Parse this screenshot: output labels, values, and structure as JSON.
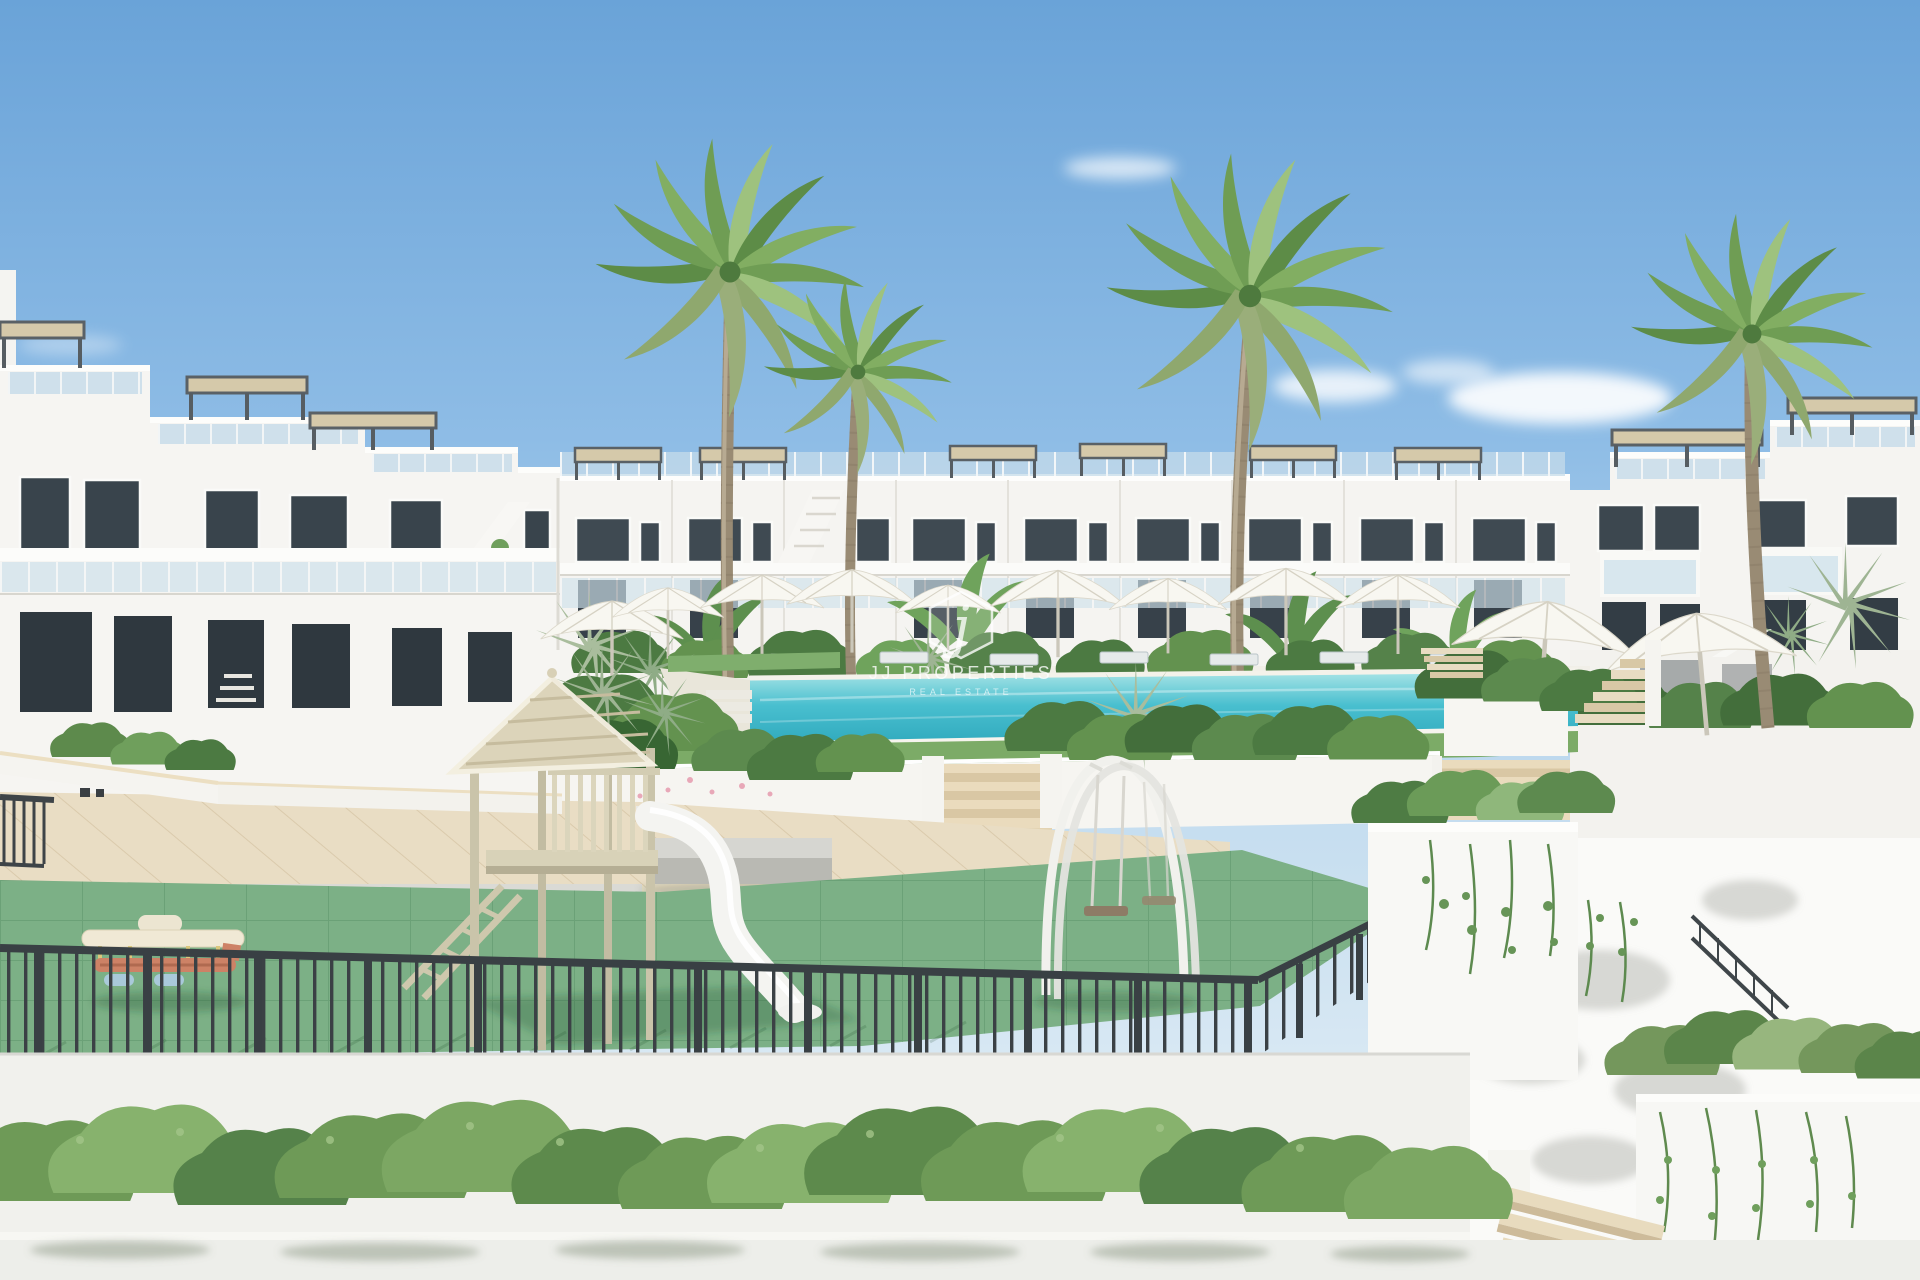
{
  "watermark": {
    "logo_letter": "j",
    "brand": "JJ PROPERTIES",
    "tagline": "REAL ESTATE"
  },
  "scene": {
    "setting": "sunny residential complex courtyard with pool and playground",
    "palette": {
      "sky_top": "#6aa3d8",
      "sky_horizon": "#e9f2f7",
      "building_white": "#f5f4f1",
      "building_shade": "#e6e4de",
      "window_glass": "#3f4a52",
      "balustrade_glass": "#c6dcea",
      "pergola_frame": "#575e63",
      "pergola_canopy": "#d5c9aa",
      "pool_light": "#a7e4e6",
      "pool_deep": "#2fa9bd",
      "lawn": "#7cab67",
      "paving": "#e9ddc4",
      "playground_floor": "#7cb086",
      "fence_metal": "#3b4145",
      "foliage_dark": "#4c7a42",
      "foliage_light": "#8fb77b",
      "concrete": "#bcbcb6",
      "timber": "#cac4aa",
      "slide_white": "#f4f4f1",
      "watermark_white": "#ffffff"
    },
    "elements": [
      "sky",
      "clouds",
      "apartment-building-left",
      "apartment-building-center",
      "apartment-building-right",
      "rooftop-pergolas",
      "rooftop-glass-railings",
      "palm-trees",
      "swimming-pool",
      "pool-umbrellas",
      "sun-loungers",
      "poolside-planters",
      "garden-stairs",
      "paved-plaza",
      "concrete-benches",
      "playground-floor",
      "playhouse-with-slide",
      "arch-swing-set",
      "toy-airplane-rocker",
      "playground-fence",
      "white-garden-walls",
      "hanging-plants",
      "garden-hedge",
      "corner-stairs",
      "watermark"
    ]
  }
}
